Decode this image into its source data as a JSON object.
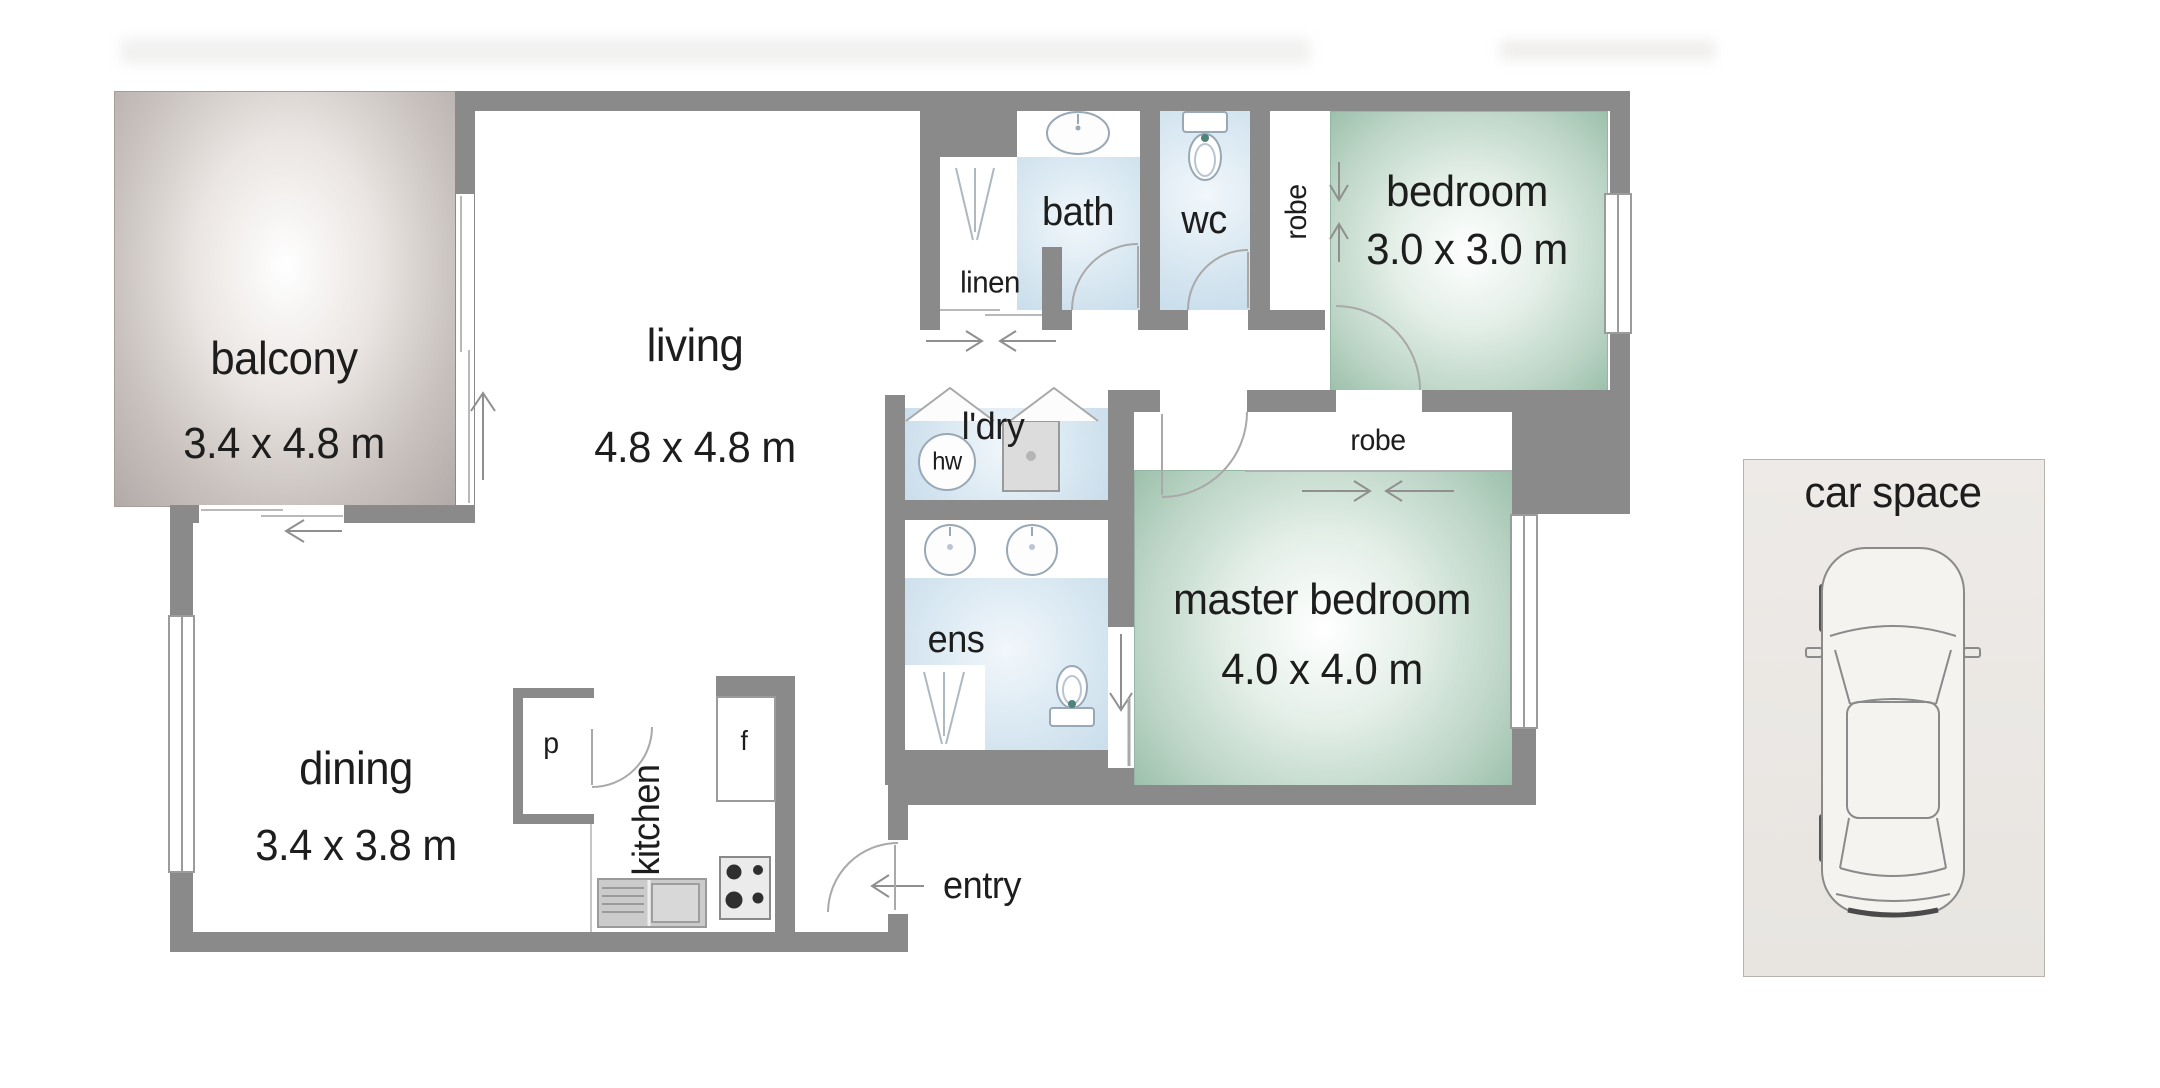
{
  "plan": {
    "rooms": [
      {
        "key": "balcony",
        "label": "balcony",
        "dims": "3.4 x 4.8 m"
      },
      {
        "key": "living",
        "label": "living",
        "dims": "4.8 x 4.8 m"
      },
      {
        "key": "dining",
        "label": "dining",
        "dims": "3.4 x 3.8 m"
      },
      {
        "key": "bedroom",
        "label": "bedroom",
        "dims": "3.0 x 3.0 m"
      },
      {
        "key": "master_bedroom",
        "label": "master bedroom",
        "dims": "4.0 x 4.0 m"
      }
    ],
    "areas": {
      "bath": "bath",
      "wc": "wc",
      "ens": "ens",
      "laundry": "l'dry",
      "linen": "linen",
      "robe_bedroom": "robe",
      "robe_master": "robe",
      "kitchen": "kitchen",
      "entry": "entry",
      "car_space": "car space"
    },
    "fixtures": {
      "hot_water": "hw",
      "pantry": "p",
      "fridge": "f"
    }
  },
  "colors": {
    "wall": "#8a8a8a",
    "line": "#9b9b9b",
    "text": "#1d1d1d",
    "wet_room": "#cfe2ef",
    "bedroom_green": "#9cc0ab",
    "balcony_grey": "#b2aaa8",
    "car_space_bg": "#e9e6e2",
    "fixture_stroke": "#98a8b6",
    "arrow": "#8f8f8f"
  }
}
